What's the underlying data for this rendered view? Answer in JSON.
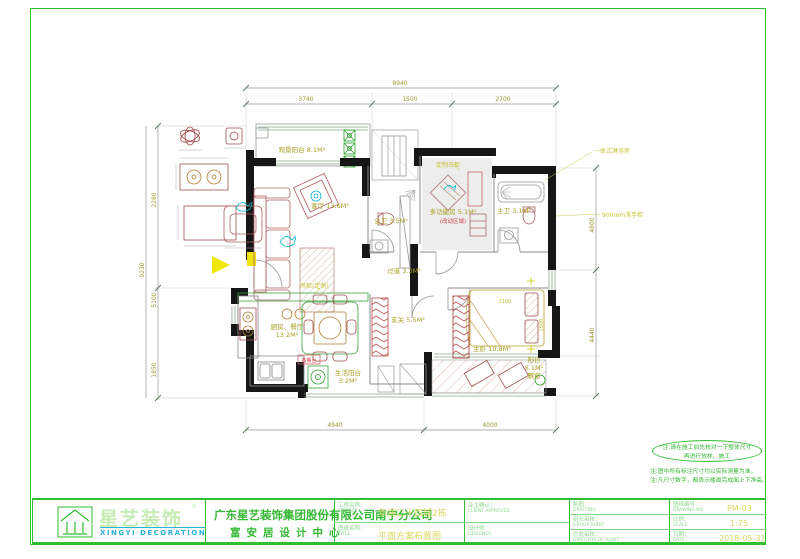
{
  "sheet": {
    "project_label_cn": "工程名称：",
    "project_label_en": "PROJECT",
    "project_value": "华润二十四城2栋",
    "title_label_cn": "图纸名称：",
    "title_label_en": "TITLE",
    "title_value": "平面方案布置图",
    "client_label_cn": "业主确认：",
    "client_label_en": "CLIENT APPROVED",
    "designer_label_cn": "设计师：",
    "designer_label_en": "DESIGNER",
    "drafting_label_cn": "制图：",
    "drafting_label_en": "DRAFTING",
    "drawingno_label_cn": "图纸编号：",
    "drawingno_label_en": "DRAWING NO",
    "drawing_no": "PM-03",
    "groupaudit_label_cn": "组长审核：",
    "groupaudit_label_en": "GROUP AUDIT",
    "scale_label_cn": "比例：",
    "scale_label_en": "SCALE",
    "scale": "1:75",
    "director_label_cn": "总监审核：",
    "director_label_en": "DIRECTOR OF AUDIT",
    "date_label_cn": "日期：",
    "date_label_en": "DATE",
    "date": "2018-05-31"
  },
  "logo": {
    "cn": "星艺装饰",
    "reg": "®",
    "en": "XINGYI DECORATION",
    "company_line1": "广东星艺装饰集团股份有限公司南宁分公司",
    "company_line2": "富安居设计中心"
  },
  "notes": {
    "oval_line1": "注:请在施工前先核对一下整体尺寸",
    "oval_line2": "再进行放样、施工",
    "line3": "注:图中所有标注尺寸均以实际测量为准，",
    "line4": "注:凡尺寸数字，都表示楼面完成面上下净高。"
  },
  "rooms": [
    {
      "name": "观景阳台",
      "area": "8.1M²"
    },
    {
      "name": "客厅",
      "area": "13.6M²"
    },
    {
      "name": "公卫",
      "area": "3.5M²"
    },
    {
      "name": "多功能房",
      "area": "5.1M²",
      "sub": "(改动区域)"
    },
    {
      "name": "主卫",
      "area": "3.1M²"
    },
    {
      "name": "厨房、餐厅",
      "area": "13.2M²"
    },
    {
      "name": "过道",
      "area": "3.3M²"
    },
    {
      "name": "玄关",
      "area": "5.5M²"
    },
    {
      "name": "主卧",
      "area": "10.8M²"
    },
    {
      "name": "生活阳台",
      "area": "3.2M²"
    },
    {
      "name": "阳台",
      "area": "5.1M²",
      "sub": "飘窗"
    }
  ],
  "annotations": {
    "cabinet": "吊柜(定制)",
    "vanity": "900mm洗手柜",
    "shower": "一体式淋浴房",
    "wardrobe": "定制衣柜",
    "serving": "备餐台"
  },
  "dimensions": {
    "top": [
      "3740",
      "1500",
      "2700"
    ],
    "top_overall": "8940",
    "left": [
      "2280",
      "5100",
      "1850"
    ],
    "left_overall": "9230",
    "right": [
      "4800",
      "4440"
    ],
    "bottom": [
      "4940",
      "4000"
    ],
    "interior": [
      "2100",
      "1500"
    ]
  },
  "colors": {
    "frame_green": "#2fbf2f",
    "label_olive": "#a8a020",
    "value_yellow": "#d8d860",
    "wall_black": "#161616",
    "furniture_brown": "#a05050",
    "accent_cyan": "#00b8c8",
    "entry_yellow": "#f2e60a"
  }
}
